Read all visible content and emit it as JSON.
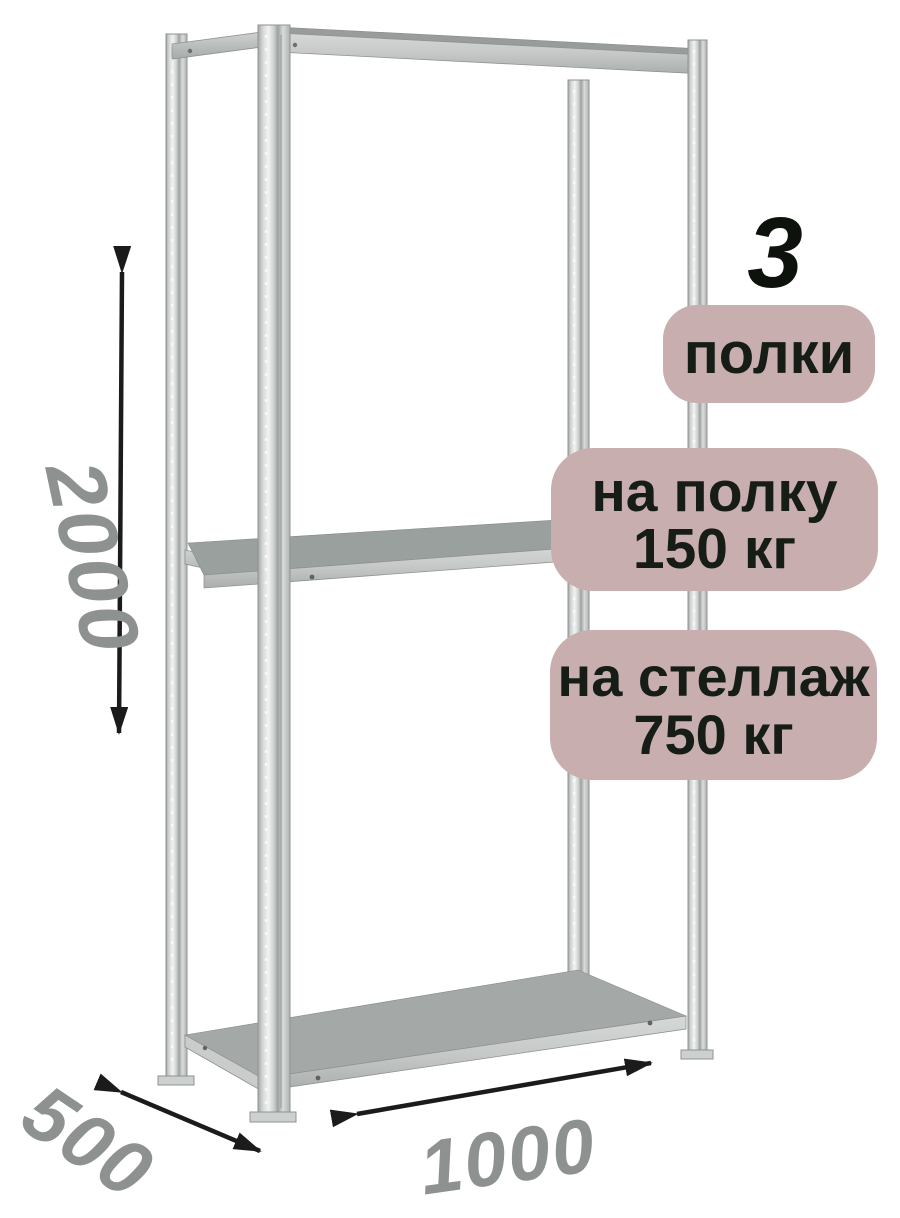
{
  "product": {
    "badges": {
      "count_number": "3",
      "count_label": "полки",
      "per_shelf_line1": "на полку",
      "per_shelf_line2": "150 кг",
      "per_rack_line1": "на стеллаж",
      "per_rack_line2": "750 кг"
    },
    "dimensions": {
      "height_mm": "2000",
      "depth_mm": "500",
      "width_mm": "1000"
    },
    "colors": {
      "badge_bg": "#c8aeae",
      "badge_text": "#161d16",
      "count_number_text": "#0d120d",
      "dimension_text": "#8d918f",
      "arrow": "#1b1b1b",
      "metal_light": "#f1f3f2",
      "metal_mid": "#c6c9c8",
      "metal_dark": "#8f9392",
      "shelf_top_middle": "#9aa09e",
      "shelf_top_bottom": "#a4a8a6"
    }
  }
}
